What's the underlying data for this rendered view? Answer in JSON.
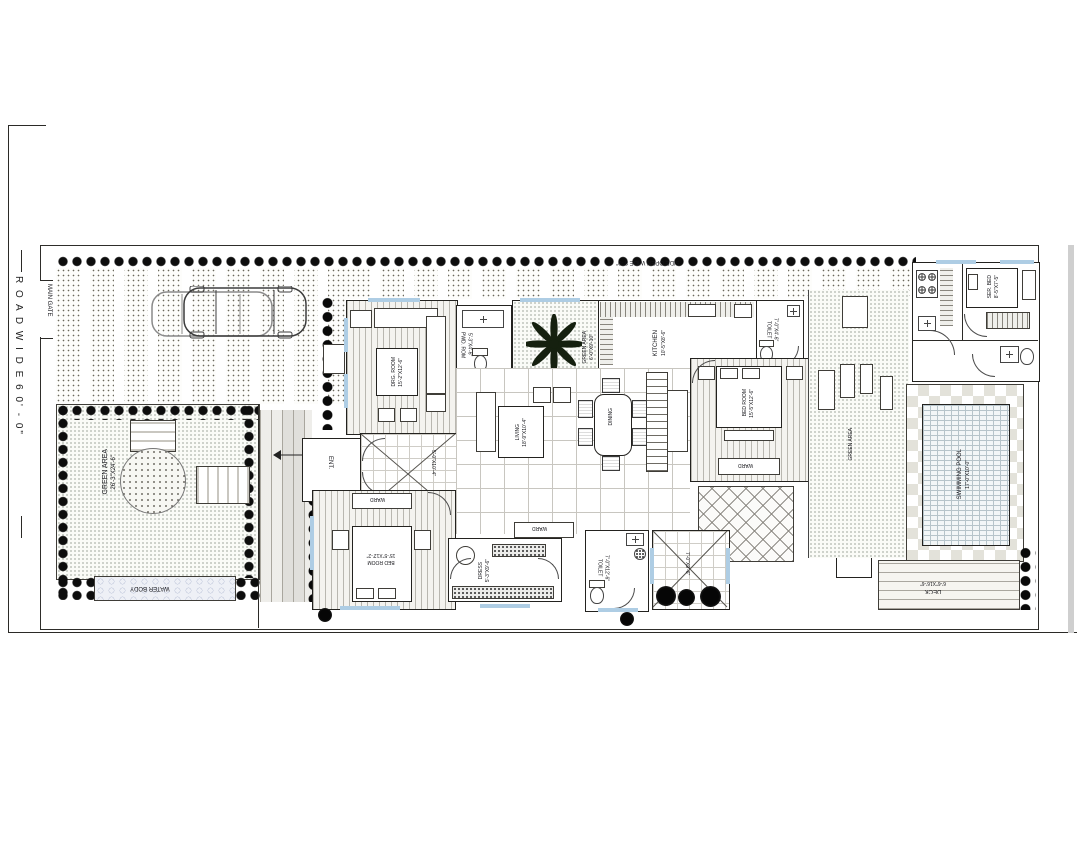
{
  "road": {
    "label": "R O A D   W I D E   6 0' - 0\""
  },
  "gate": {
    "label": "MAIN GATE"
  },
  "side_open": {
    "label": "SIDE OPEN WIDE 8'-0\""
  },
  "garden": {
    "green_main_name": "GREEN AREA",
    "green_main_dim": "26'-3\"X24'-6\"",
    "water_body": "WATER BODY",
    "court_green_name": "GREEN AREA",
    "court_green_dim": "6'-0\"X9'-10\"",
    "green_right": "GREEN AREA",
    "pool_name": "SWIMMING POOL",
    "pool_dim": "17'-0\"X10'-0\"",
    "deck_name": "DECK",
    "deck_dim": "6'-6\"X16'-6\""
  },
  "rooms": {
    "drg_name": "DRG. ROOM",
    "drg_dim": "15'-2\"X12'-6\"",
    "foyer_dim": "5'-0\"X10'-4\"",
    "ent": "ENT.",
    "pwd_name": "PWD. ROM",
    "pwd_dim": "5'-3\"X4'-6\"",
    "kitchen_name": "KITCHEN",
    "kitchen_dim": "10'-5\"X8'-6\"",
    "toilet_top_name": "TOILET",
    "toilet_top_dim": "7'-0\"X4'-6\"",
    "living_name": "LIVING",
    "living_dim": "18'-9\"X10'-4\"",
    "dining": "DINING",
    "mbed_name": "BED ROOM",
    "mbed_dim": "15'-5\"X12'-6\"",
    "ward": "WARD",
    "bed2_name": "BED ROOM",
    "bed2_dim": "15'-5\"X12'-2\"",
    "dress_name": "DRESS",
    "dress_dim": "5'-3\"X9'-6\"",
    "toilet2_name": "TOILET",
    "toilet2_dim": "7'-0\"X12'-6\"",
    "court_dim": "7'-0\"X9'-6\"",
    "serbed_name": "SER. BED",
    "serbed_dim": "8'-5\"X7'-5\"",
    "wt": "W.T."
  }
}
